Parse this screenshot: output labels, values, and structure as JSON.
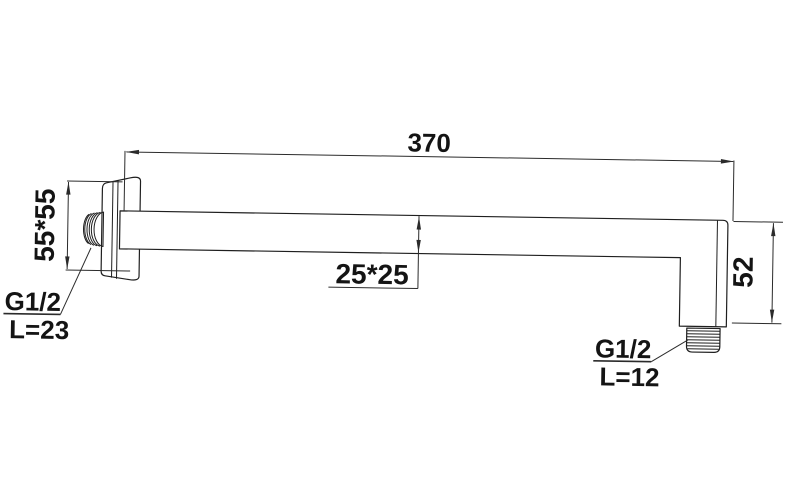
{
  "drawing": {
    "background": "#ffffff",
    "line_color": "#1f1f1f",
    "dim_color": "#2b2b2b",
    "text_color": "#141414",
    "dim_length": "370",
    "dim_flange": "55*55",
    "dim_tube": "25*25",
    "dim_drop": "52",
    "wall_thread": {
      "type": "G1/2",
      "length": "L=23"
    },
    "outlet_thread": {
      "type": "G1/2",
      "length": "L=12"
    }
  }
}
